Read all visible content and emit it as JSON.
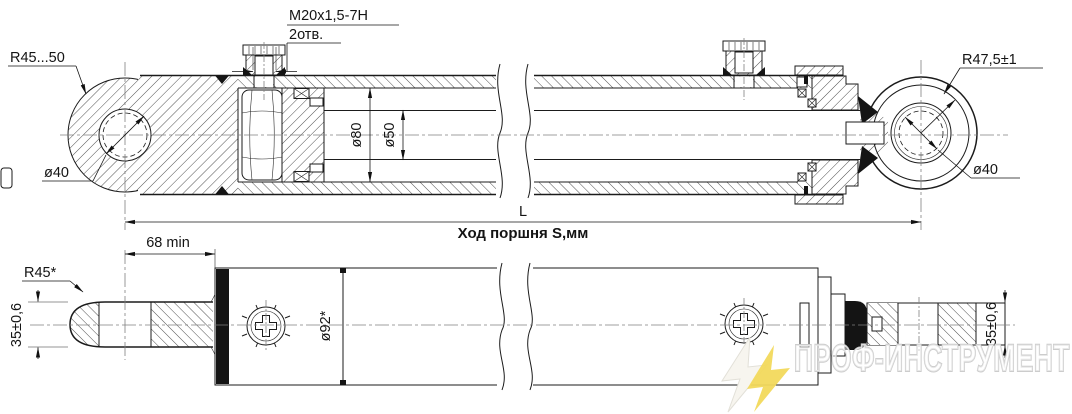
{
  "drawing_type": "hydraulic-cylinder-technical-drawing",
  "colors": {
    "line": "#1b1b1b",
    "background": "#ffffff"
  },
  "views": {
    "section_view": {
      "labels": {
        "port_thread": "M20x1,5-7H",
        "port_count": "2отв.",
        "rod_eye_radius": "R45...50",
        "rod_eye_hole_dia": "ø40",
        "bore_dia": "ø80",
        "rod_dia": "ø50",
        "head_eye_radius": "R47,5±1",
        "head_eye_hole_dia": "ø40",
        "overall_length": "L",
        "stroke_note": "Ход поршня S,мм"
      }
    },
    "external_view": {
      "labels": {
        "min_clearance": "68 min",
        "eye_radius": "R45*",
        "eye_width_left": "35±0,6",
        "body_dia": "ø92*",
        "pin_width_right": "35±0,6"
      }
    }
  },
  "watermark": {
    "text": "ПРОФ-ИНСТРУМЕНТ",
    "bolt_color": "#F2D95C",
    "bolt_light_color": "#F7F5EF",
    "outline_color": "#CCCCCC"
  }
}
